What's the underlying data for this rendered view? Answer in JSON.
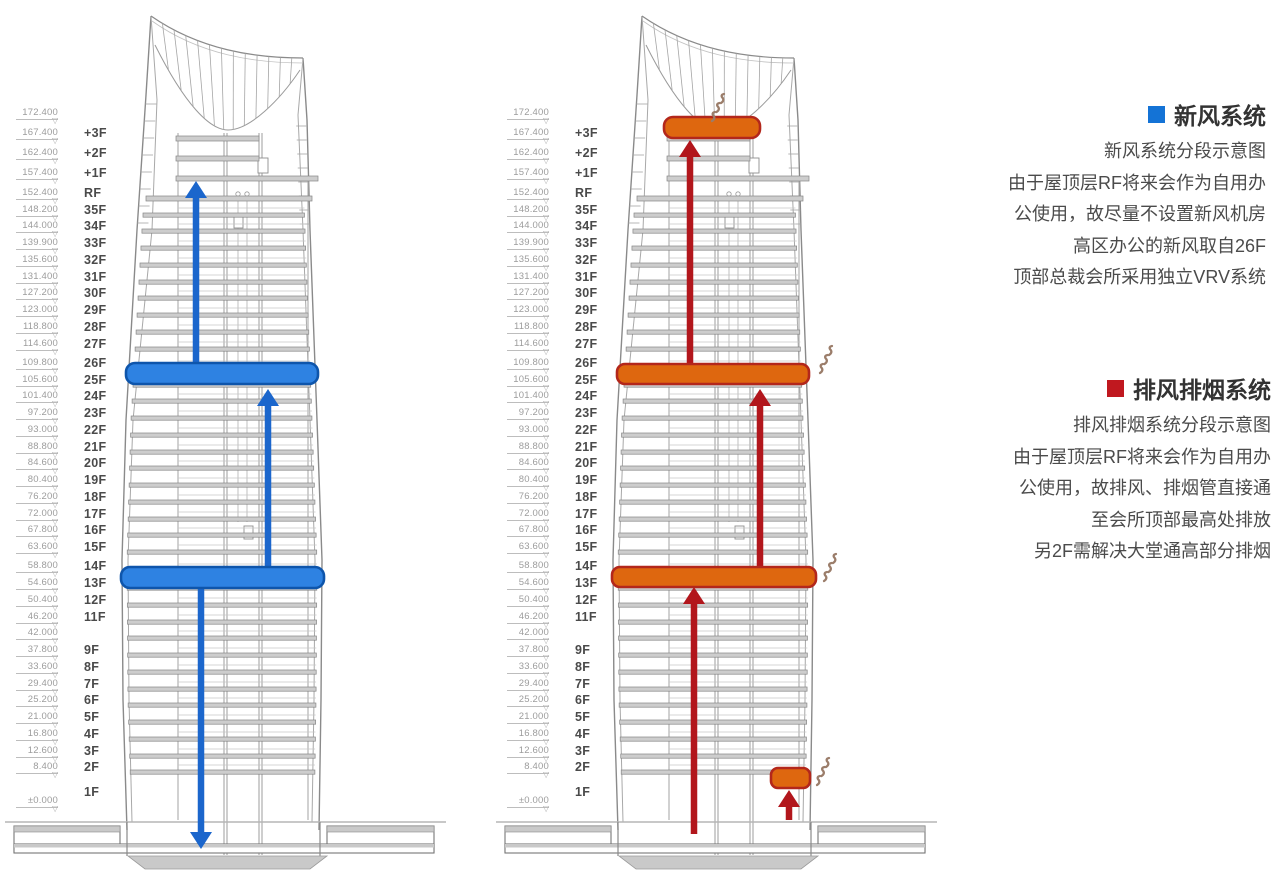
{
  "canvas": {
    "width": 1280,
    "height": 883,
    "background": "#ffffff"
  },
  "legend": {
    "fresh_air": {
      "title": "新风系统",
      "square_color": "#1473d6",
      "square_icon": "blue-square-icon",
      "lines": [
        "新风系统分段示意图",
        "由于屋顶层RF将来会作为自用办",
        "公使用，故尽量不设置新风机房",
        "高区办公的新风取自26F",
        "顶部总裁会所采用独立VRV系统"
      ]
    },
    "exhaust": {
      "title": "排风排烟系统",
      "square_color": "#c0181f",
      "square_icon": "red-square-icon",
      "lines": [
        "排风排烟系统分段示意图",
        "由于屋顶层RF将来会作为自用办",
        "公使用，故排风、排烟管直接通",
        "至会所顶部最高处排放",
        "另2F需解决大堂通高部分排烟"
      ]
    }
  },
  "scale_glyphs": {
    "triangle": "▽"
  },
  "scale_rows": [
    {
      "elev": "172.400",
      "floor": ""
    },
    {
      "elev": "167.400",
      "floor": "+3F"
    },
    {
      "elev": "162.400",
      "floor": "+2F"
    },
    {
      "elev": "157.400",
      "floor": "+1F"
    },
    {
      "elev": "152.400",
      "floor": "RF"
    },
    {
      "elev": "148.200",
      "floor": "35F"
    },
    {
      "elev": "144.000",
      "floor": "34F"
    },
    {
      "elev": "139.900",
      "floor": "33F"
    },
    {
      "elev": "135.600",
      "floor": "32F"
    },
    {
      "elev": "131.400",
      "floor": "31F"
    },
    {
      "elev": "127.200",
      "floor": "30F"
    },
    {
      "elev": "123.000",
      "floor": "29F"
    },
    {
      "elev": "118.800",
      "floor": "28F"
    },
    {
      "elev": "114.600",
      "floor": "27F"
    },
    {
      "elev": "109.800",
      "floor": "26F"
    },
    {
      "elev": "105.600",
      "floor": "25F"
    },
    {
      "elev": "101.400",
      "floor": "24F"
    },
    {
      "elev": "97.200",
      "floor": "23F"
    },
    {
      "elev": "93.000",
      "floor": "22F"
    },
    {
      "elev": "88.800",
      "floor": "21F"
    },
    {
      "elev": "84.600",
      "floor": "20F"
    },
    {
      "elev": "80.400",
      "floor": "19F"
    },
    {
      "elev": "76.200",
      "floor": "18F"
    },
    {
      "elev": "72.000",
      "floor": "17F"
    },
    {
      "elev": "67.800",
      "floor": "16F"
    },
    {
      "elev": "63.600",
      "floor": "15F"
    },
    {
      "elev": "58.800",
      "floor": "14F"
    },
    {
      "elev": "54.600",
      "floor": "13F"
    },
    {
      "elev": "50.400",
      "floor": "12F"
    },
    {
      "elev": "46.200",
      "floor": "11F"
    },
    {
      "elev": "42.000",
      "floor": ""
    },
    {
      "elev": "37.800",
      "floor": "9F"
    },
    {
      "elev": "33.600",
      "floor": "8F"
    },
    {
      "elev": "29.400",
      "floor": "7F"
    },
    {
      "elev": "25.200",
      "floor": "6F"
    },
    {
      "elev": "21.000",
      "floor": "5F"
    },
    {
      "elev": "16.800",
      "floor": "4F"
    },
    {
      "elev": "12.600",
      "floor": "3F"
    },
    {
      "elev": "8.400",
      "floor": "2F"
    },
    {
      "elev": "",
      "floor": "1F"
    },
    {
      "elev": "±0.000",
      "floor": ""
    }
  ],
  "towers": {
    "offsets": [
      0,
      491
    ],
    "line_color": "#8a8a8a",
    "slab_fill": "#cdcdcd",
    "slab_stroke": "#878787",
    "overlays": {
      "fresh_air": {
        "system_label": "新风系统",
        "fill": "#2e82e2",
        "stroke": "#0e55ab",
        "arrow": "#1b66cc",
        "bars": [
          {
            "floor": "26F",
            "x": 126,
            "y": 363,
            "w": 192,
            "h": 21,
            "rx": 9
          },
          {
            "floor": "14F",
            "x": 121,
            "y": 567,
            "w": 203,
            "h": 21,
            "rx": 9
          }
        ],
        "arrows": [
          {
            "x": 196,
            "from": 363,
            "to": 181
          },
          {
            "x": 268,
            "from": 567,
            "to": 389
          },
          {
            "x": 201,
            "from": 588,
            "to": 849
          }
        ],
        "smokes": []
      },
      "exhaust": {
        "system_label": "排风排烟系统",
        "fill": "#de670f",
        "stroke": "#b3271b",
        "arrow": "#b2161c",
        "smoke_color": "#9b7d6a",
        "bars": [
          {
            "floor": "roof",
            "x": 173,
            "y": 117,
            "w": 96,
            "h": 21,
            "rx": 9
          },
          {
            "floor": "26F",
            "x": 126,
            "y": 364,
            "w": 192,
            "h": 20,
            "rx": 8
          },
          {
            "floor": "14F",
            "x": 121,
            "y": 567,
            "w": 204,
            "h": 20,
            "rx": 8
          },
          {
            "floor": "2F",
            "x": 280,
            "y": 768,
            "w": 39,
            "h": 20,
            "rx": 7
          }
        ],
        "arrows": [
          {
            "x": 199,
            "from": 364,
            "to": 140
          },
          {
            "x": 269,
            "from": 567,
            "to": 389
          },
          {
            "x": 203,
            "from": 834,
            "to": 587
          },
          {
            "x": 298,
            "from": 820,
            "to": 790
          }
        ],
        "smokes": [
          {
            "x": 221,
            "y": 94
          },
          {
            "x": 329,
            "y": 346
          },
          {
            "x": 333,
            "y": 554
          },
          {
            "x": 326,
            "y": 758
          }
        ]
      }
    }
  }
}
